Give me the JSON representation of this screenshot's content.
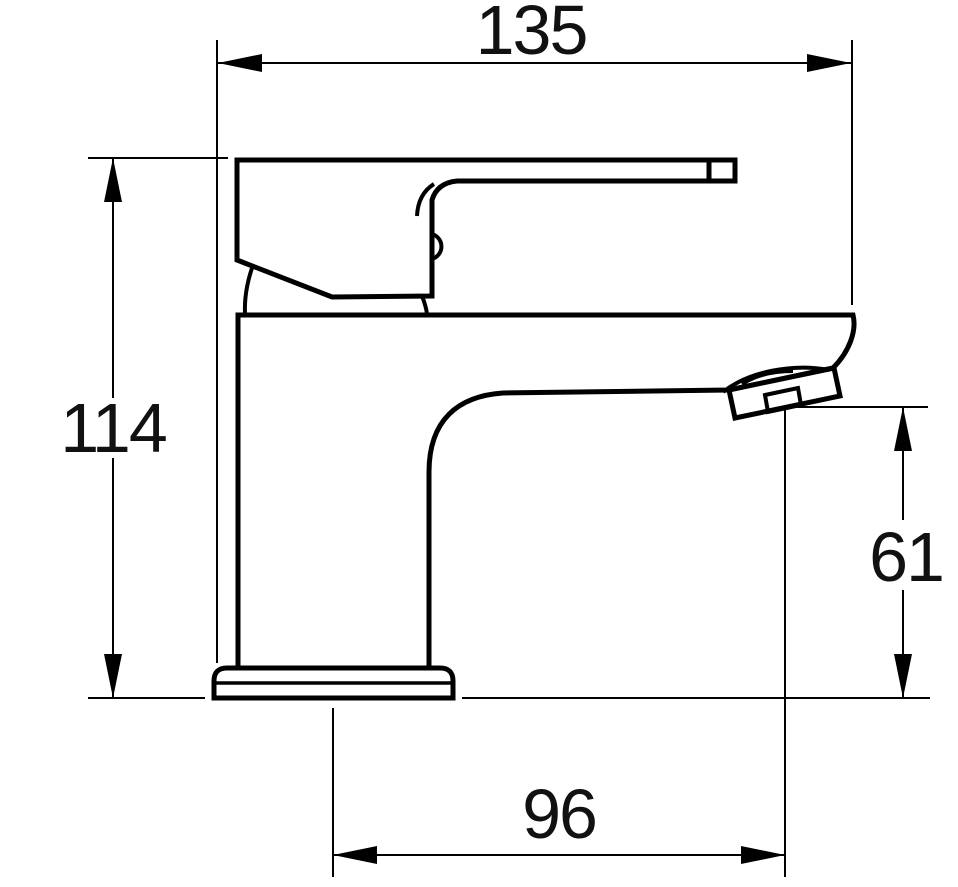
{
  "diagram": {
    "type": "technical-dimension-drawing",
    "subject": "single-lever basin mixer tap, side elevation",
    "background_color": "#ffffff",
    "line_color": "#000000",
    "dimensions": {
      "overall_length": "135",
      "overall_height": "114",
      "spout_outlet_height": "61",
      "spout_reach": "96"
    }
  }
}
